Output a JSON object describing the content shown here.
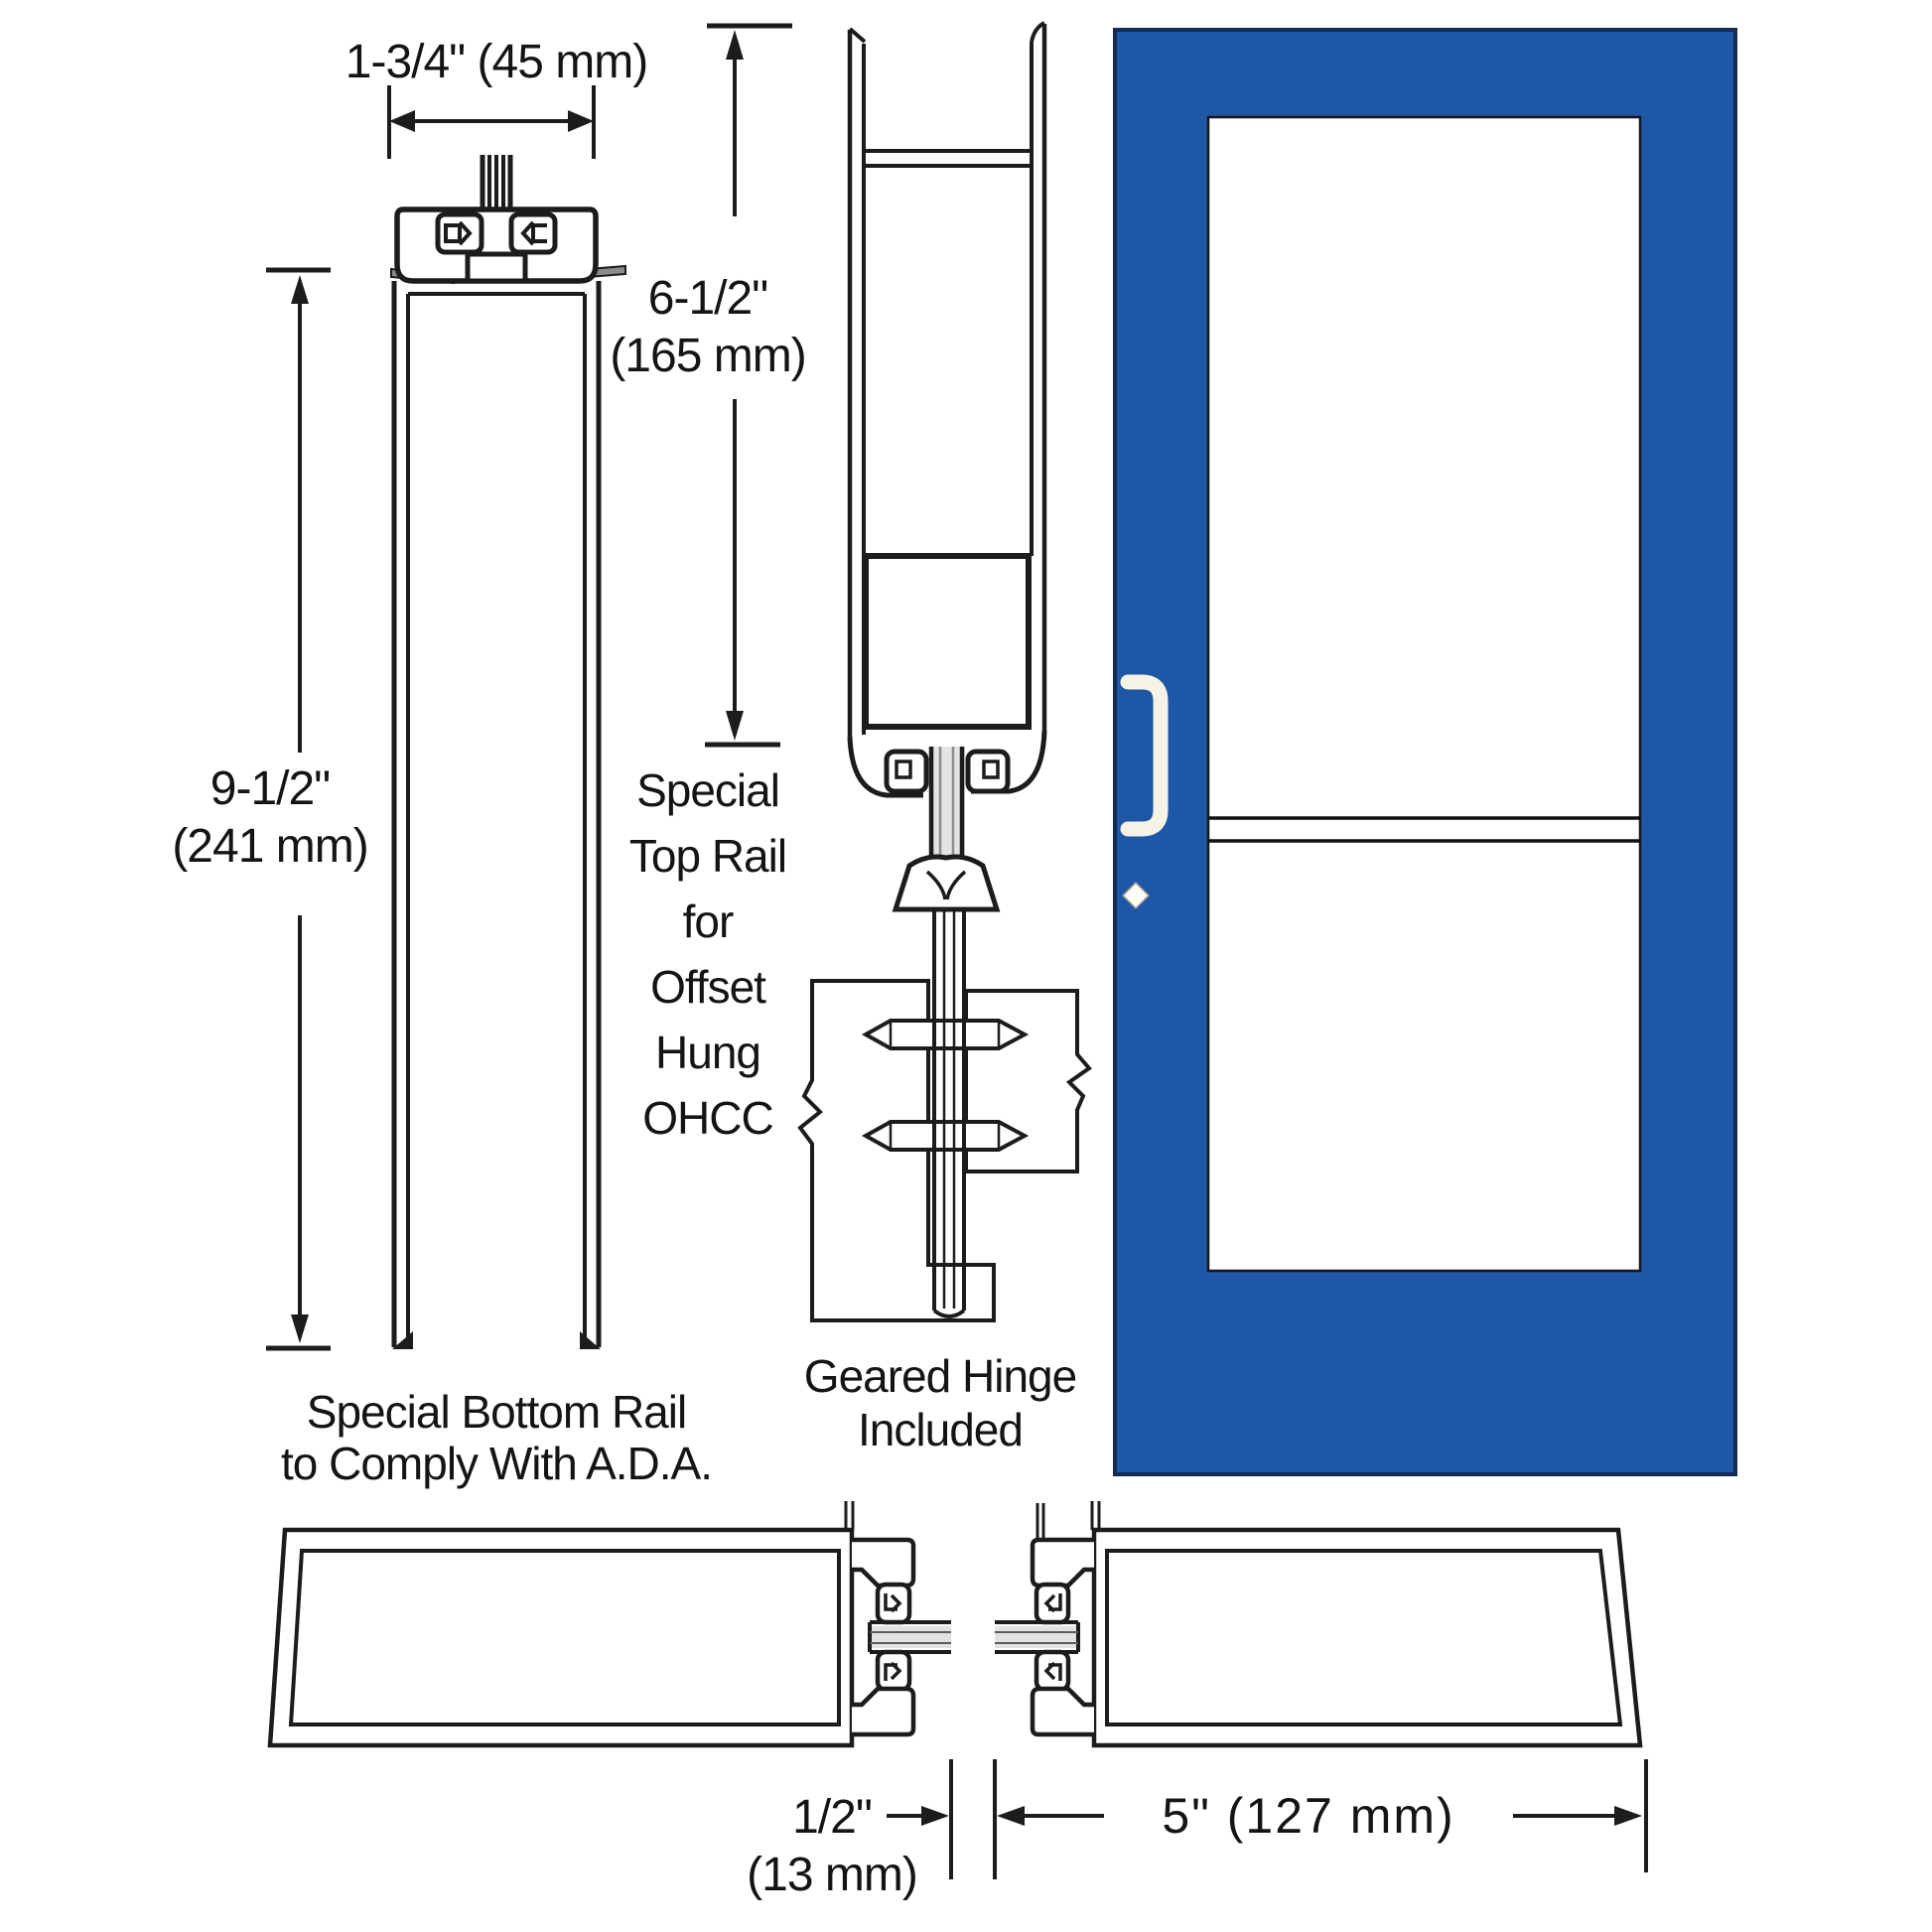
{
  "title": "Storefront Door Cross-Section Diagram",
  "colors": {
    "line": "#1c1c1c",
    "door_blue": "#1e57a5",
    "door_edge": "#132b52",
    "glass_white": "#ffffff",
    "handle_cream": "#f6f2e6",
    "glazing_gray": "#e2e2e2"
  },
  "dimensions": {
    "rail_width": "1-3/4\" (45 mm)",
    "bottom_rail_height_in": "9-1/2\"",
    "bottom_rail_height_mm": "(241 mm)",
    "top_rail_height_in": "6-1/2\"",
    "top_rail_height_mm": "(165 mm)",
    "stile_gap_in": "1/2\"",
    "stile_gap_mm": "(13 mm)",
    "stile_width": "5\" (127 mm)"
  },
  "captions": {
    "bottom_rail_line1": "Special Bottom Rail",
    "bottom_rail_line2": "to Comply With A.D.A.",
    "top_rail_lines": [
      "Special",
      "Top Rail",
      "for",
      "Offset",
      "Hung",
      "OHCC"
    ],
    "hinge_line1": "Geared Hinge",
    "hinge_line2": "Included"
  }
}
